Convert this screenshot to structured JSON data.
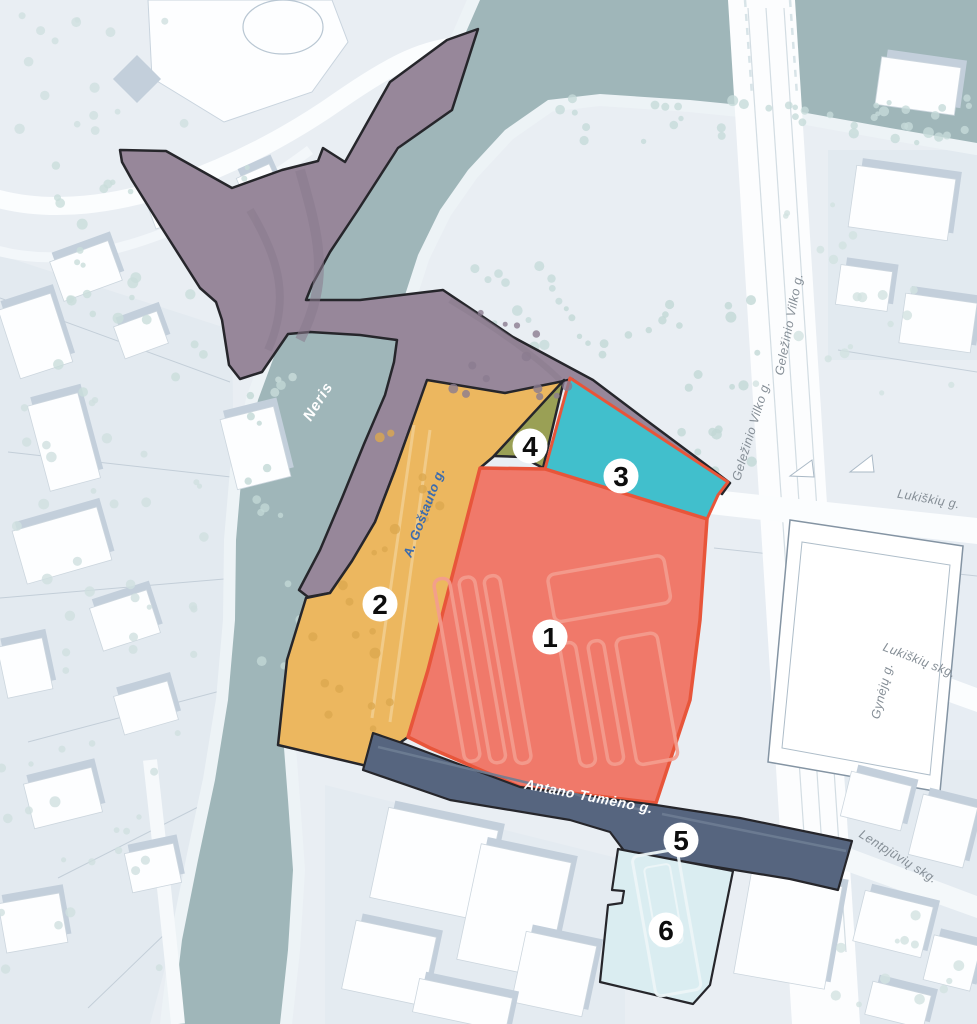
{
  "labels": {
    "river": "Neris",
    "gostauto": "A. Goštauto g.",
    "gelezinio_vilko_upper": "Geležinio Vilko g.",
    "gelezinio_vilko_lower": "Geležinio Vilko g.",
    "lukiskiu": "Lukiškių g.",
    "lukiskiu_skg": "Lukiškių skg.",
    "gyneju": "Gynėjų g.",
    "antano_tumeno": "Antano Tumėno g.",
    "lentpjuviu_skg": "Lentpjūvių skg."
  },
  "zones": [
    {
      "number": "1",
      "fill": "#f0796a",
      "border": "#e8553a"
    },
    {
      "number": "2",
      "fill": "#ecb75f",
      "border": "#26262b"
    },
    {
      "number": "3",
      "fill": "#41bfcc",
      "border": "#e8553a"
    },
    {
      "number": "4",
      "fill": "#9aa055",
      "border": "#26262b"
    },
    {
      "number": "5",
      "fill": "#56657f",
      "border": "#26262b"
    },
    {
      "number": "6",
      "fill": "#daedf1",
      "border": "#26262b"
    }
  ],
  "palette": {
    "background": "#e9eef3",
    "river": "#9fb6b9",
    "road": "#97879a",
    "road_outline": "#26262b"
  }
}
